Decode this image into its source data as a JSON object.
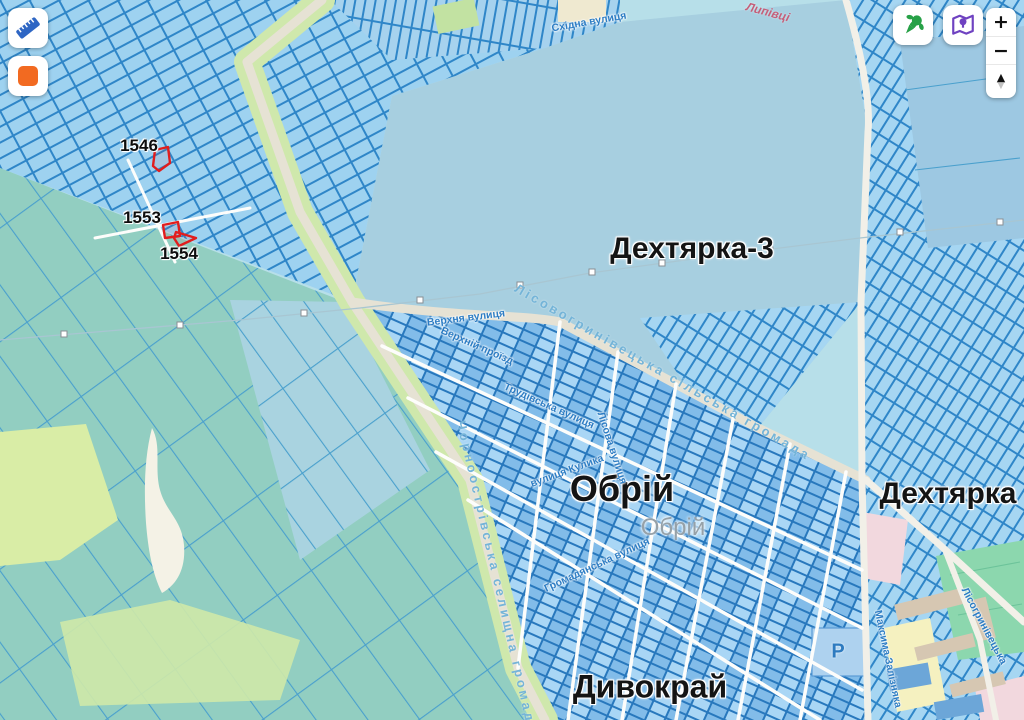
{
  "map": {
    "labels": [
      {
        "name": "place-label-dekhtyarka-3",
        "cls": "place",
        "text": "Дехтярка-3",
        "x": 692,
        "y": 249,
        "size": 30
      },
      {
        "name": "place-label-obrii",
        "cls": "place",
        "text": "Обрій",
        "x": 622,
        "y": 489,
        "size": 36
      },
      {
        "name": "place-label-dekhtyarka",
        "cls": "place",
        "text": "Дехтярка",
        "x": 948,
        "y": 494,
        "size": 30
      },
      {
        "name": "place-label-dyvokrai",
        "cls": "place",
        "text": "Дивокрай",
        "x": 650,
        "y": 687,
        "size": 32
      },
      {
        "name": "basemap-label-obrii",
        "cls": "place-muted",
        "text": "Обрій",
        "x": 673,
        "y": 528
      },
      {
        "name": "parcel-number-1546",
        "cls": "parcel-num",
        "text": "1546",
        "x": 139,
        "y": 146
      },
      {
        "name": "parcel-number-1553",
        "cls": "parcel-num",
        "text": "1553",
        "x": 142,
        "y": 218
      },
      {
        "name": "parcel-number-1554",
        "cls": "parcel-num",
        "text": "1554",
        "x": 179,
        "y": 254
      },
      {
        "name": "street-label-skhidna",
        "cls": "street",
        "text": "Східна вулиця",
        "x": 589,
        "y": 22,
        "rot": -10
      },
      {
        "name": "street-label-verkhnia",
        "cls": "street",
        "text": "Верхня вулиця",
        "x": 466,
        "y": 318,
        "rot": -7
      },
      {
        "name": "street-label-verkhnii-proizd",
        "cls": "street",
        "text": "Верхній проїзд",
        "x": 477,
        "y": 346,
        "rot": 24
      },
      {
        "name": "street-label-trudivska",
        "cls": "street",
        "text": "Трудівська вулиця",
        "x": 549,
        "y": 406,
        "rot": 24
      },
      {
        "name": "street-label-lisova",
        "cls": "street",
        "text": "Лісова вулиця",
        "x": 612,
        "y": 448,
        "rot": 72
      },
      {
        "name": "street-label-kulyka",
        "cls": "street",
        "text": "вулиця Кулика",
        "x": 567,
        "y": 471,
        "rot": -20
      },
      {
        "name": "street-label-hromadianska",
        "cls": "street",
        "text": "Громадянська вулиця",
        "x": 597,
        "y": 565,
        "rot": -25
      },
      {
        "name": "street-label-maksyma-zalizniaka",
        "cls": "street",
        "text": "Максима Залізняка",
        "x": 888,
        "y": 659,
        "rot": 78
      },
      {
        "name": "street-label-lisohrynivetska",
        "cls": "street",
        "text": "Лісогринівецька",
        "x": 984,
        "y": 626,
        "rot": 62
      },
      {
        "name": "boundary-label-lisovohrynivetska-hromada",
        "cls": "boundary",
        "text": "Лісовогринівецька сільська громада",
        "x": 663,
        "y": 372,
        "rot": 30
      },
      {
        "name": "boundary-label-chornoostrivska-hromada",
        "cls": "boundary",
        "text": "Чорноострівська селищна громада",
        "x": 497,
        "y": 577,
        "rot": 77
      },
      {
        "name": "stream-label",
        "cls": "stream",
        "text": "Липівці",
        "x": 768,
        "y": 12,
        "rot": 15
      },
      {
        "name": "parking-letter",
        "cls": "poi",
        "text": "P",
        "x": 838,
        "y": 652
      }
    ],
    "highlighted_parcels": [
      {
        "id": "1546",
        "points": "155,150 168,147 170,163 159,171 153,166"
      },
      {
        "id": "1553",
        "points": "163,225 178,222 180,236 165,238"
      },
      {
        "id": "1554",
        "points": "176,232 196,238 179,246 174,238"
      }
    ],
    "colors": {
      "parcel_stroke": "#2f86c8",
      "highlight": "#e11d1d",
      "field_teal": "#92cec1",
      "background": "#b7dfe9"
    }
  },
  "controls": {
    "measure_button_icon": "ruler-icon",
    "draw_button_icon": "orange-square-icon",
    "nature_button_icon": "green-pin-icon",
    "basemap_button_icon": "purple-map-icon",
    "zoom_in": "+",
    "zoom_out": "−",
    "tilt_up": "▲",
    "tilt_down": "▼",
    "accent_orange": "#f26a21",
    "accent_green": "#27a147",
    "accent_purple": "#6f42c1",
    "accent_blue": "#2e66c4"
  }
}
